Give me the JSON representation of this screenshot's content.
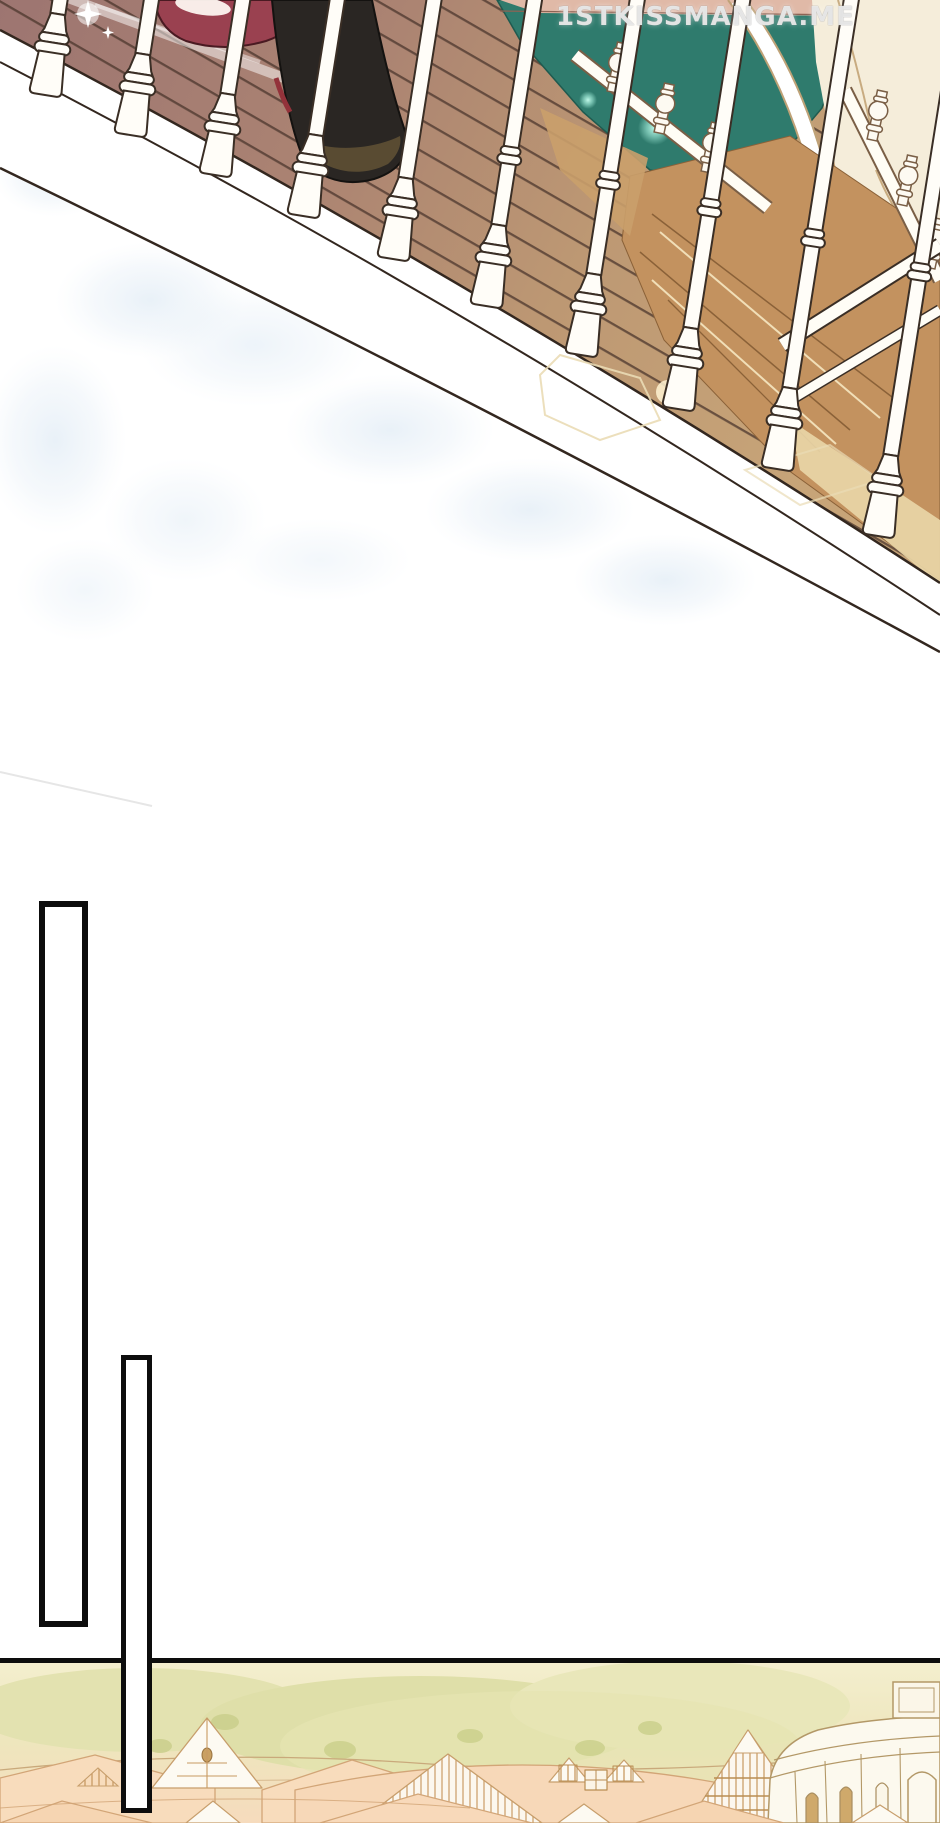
{
  "page": {
    "kind": "webtoon comic page",
    "background": "#ffffff"
  },
  "watermark": {
    "text": "1STKISSMANGA.ME",
    "color": "rgba(244,244,244,0.85)"
  },
  "scene_top": {
    "name": "terrace balustrade over pond",
    "elements": [
      "wooden deck planks",
      "white turned balusters",
      "teal pond water",
      "glowing light on water",
      "white arch bridge",
      "tan staircase",
      "cream wall",
      "distant ball-top railing",
      "red shoe",
      "black boot",
      "white sparkle",
      "white fascia edge band",
      "faint blue watercolor texture"
    ]
  },
  "empty_panels": [
    {
      "label": "tall empty vertical rectangle (left)"
    },
    {
      "label": "tall empty vertical rectangle (overlapping bottom panel)"
    }
  ],
  "scene_bottom": {
    "name": "village rooftops panorama",
    "elements": [
      "pale tree line",
      "peach gabled rooftops",
      "white gables",
      "half-timbered houses",
      "dormer windows",
      "white domed rotunda building",
      "arched windows"
    ]
  },
  "colors": {
    "panel_border": "#0d0d0d",
    "deck_wood_left": "#9d7571",
    "deck_wood_right": "#c7a478",
    "plank_line": "#4a352c",
    "water_teal": "#2f7b6d",
    "water_glow": "#aef7e4",
    "far_deck_pink": "#e0b9a7",
    "baluster_white": "#fffdf8",
    "baluster_outline": "#3a2e25",
    "red_shoe": "#9a4150",
    "black_boot": "#2a2623",
    "boot_sole": "#5e5034",
    "stairs_tan": "#c3925f",
    "stair_line": "#8a6138",
    "cream_wall": "#f5edda",
    "watercolor_blue": "#d6e5f2",
    "village_sky": "#f4efcf",
    "village_trees": "#e0e0ab",
    "village_roof": "#f8dcbc",
    "village_roof_line": "#d2a577",
    "village_gable": "#fdfaf2",
    "rotunda_wall": "#fcf9ee",
    "rotunda_line": "#b39867"
  }
}
